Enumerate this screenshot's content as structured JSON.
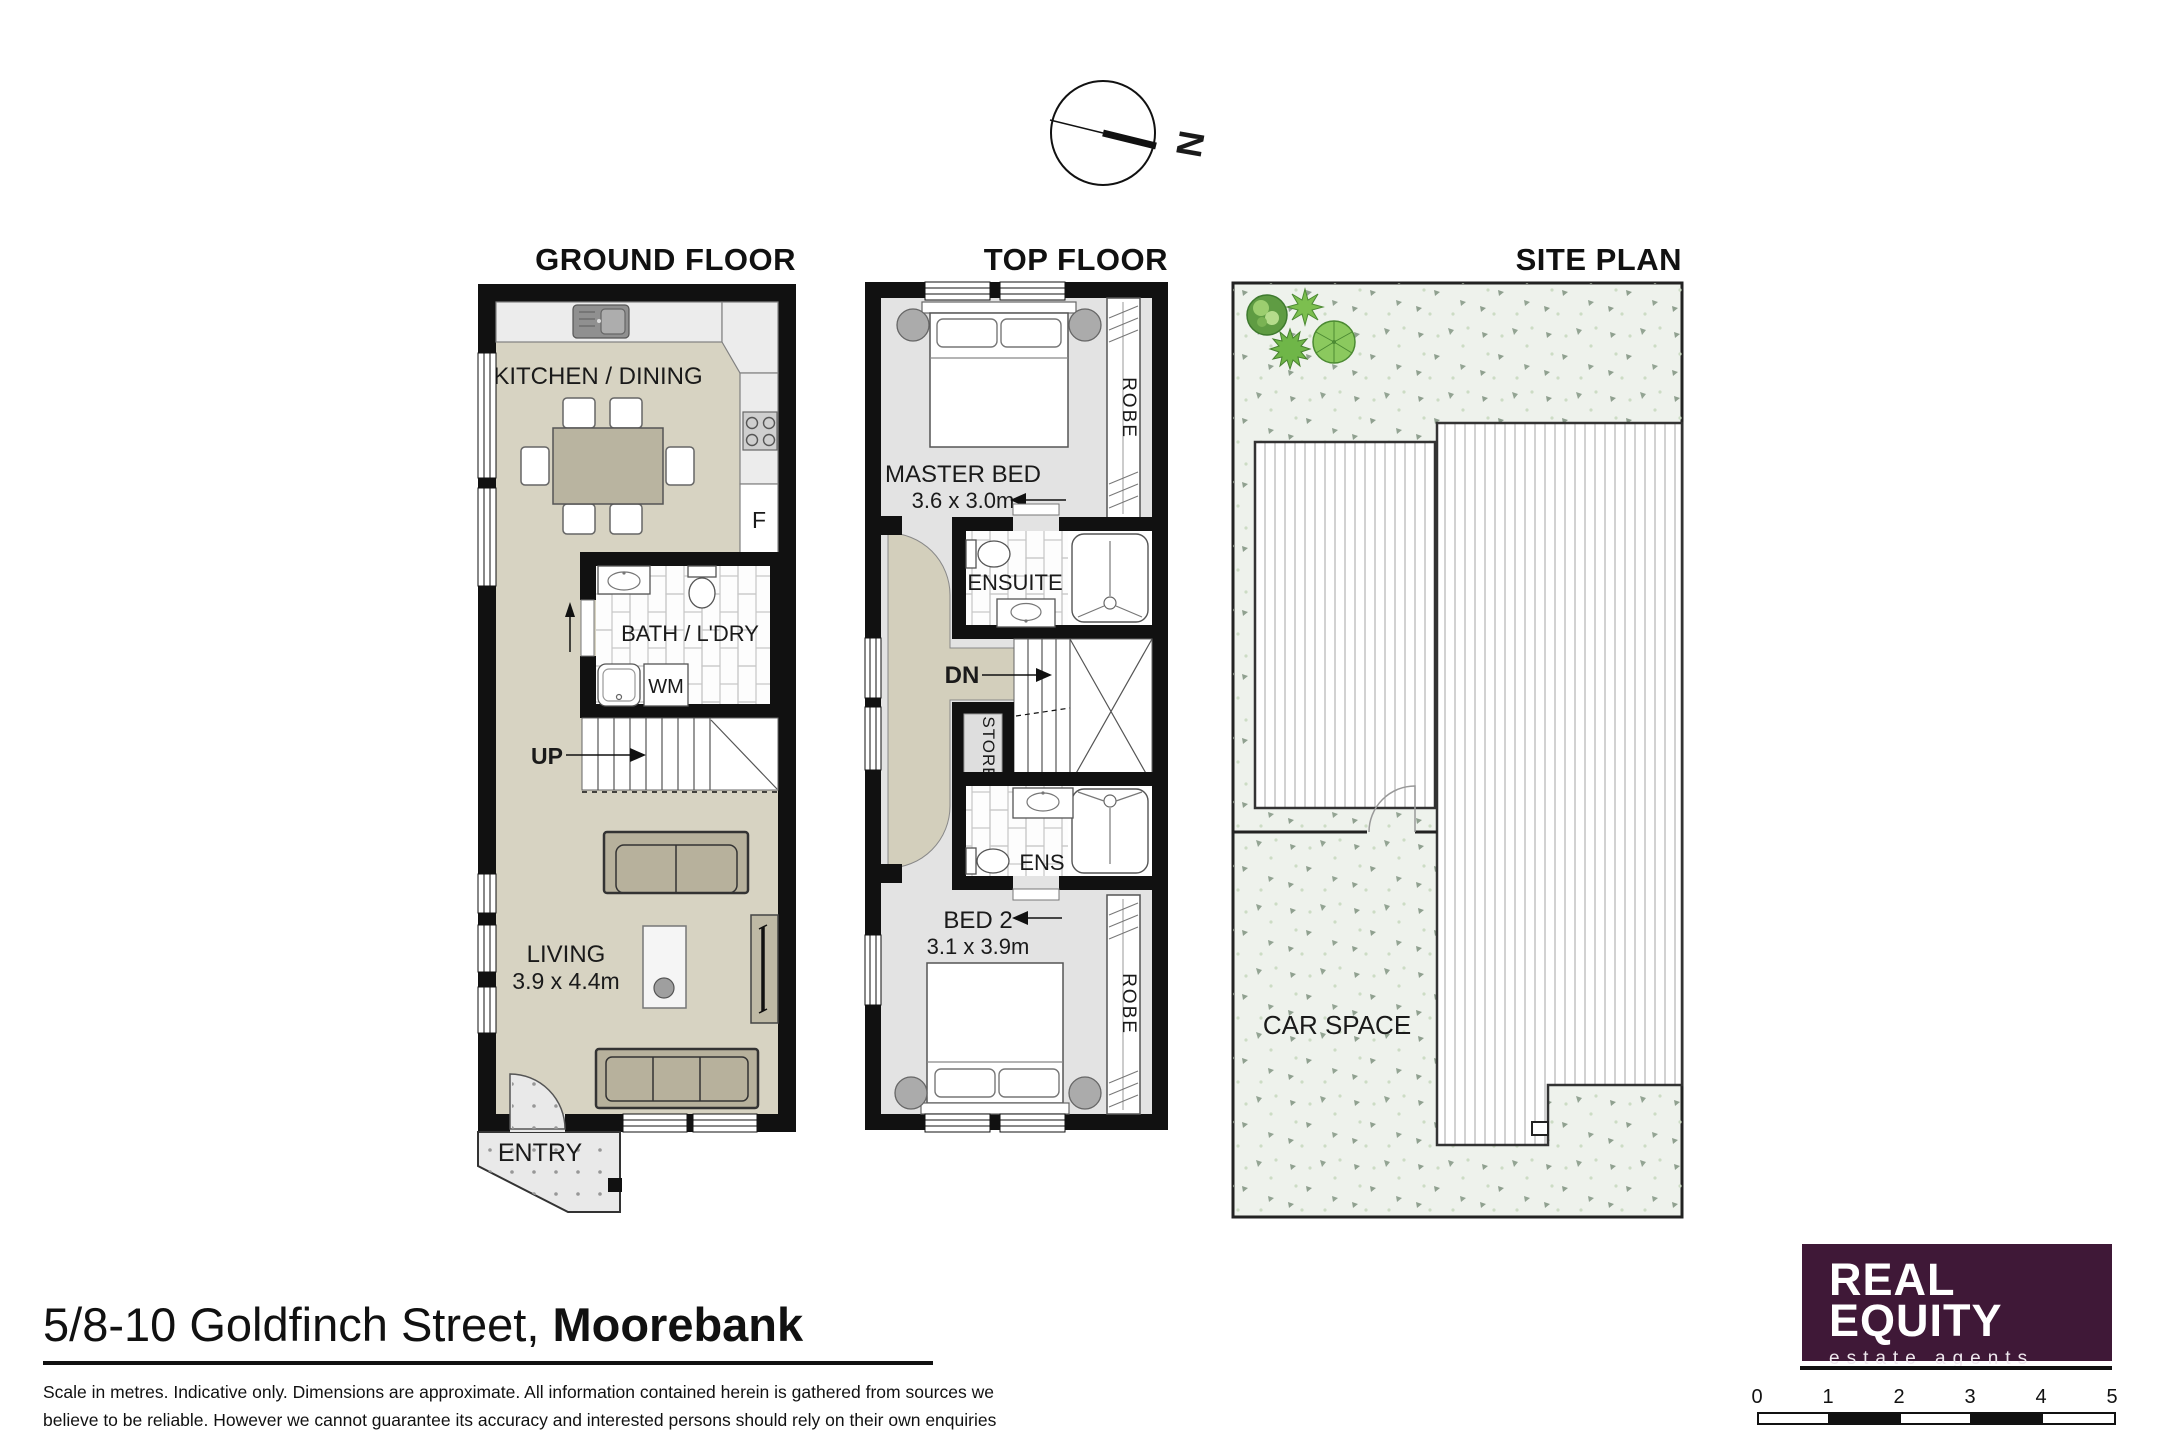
{
  "compass": {
    "north_label": "N"
  },
  "plans": {
    "ground_floor": {
      "title": "GROUND FLOOR",
      "labels": {
        "kitchen_dining": "KITCHEN / DINING",
        "fridge": "F",
        "bath_laundry": "BATH / L'DRY",
        "washing_machine": "WM",
        "stairs_up": "UP",
        "living": "LIVING",
        "living_dimensions": "3.9 x 4.4m",
        "entry": "ENTRY"
      }
    },
    "top_floor": {
      "title": "TOP FLOOR",
      "labels": {
        "master_bed": "MASTER BED",
        "master_bed_dimensions": "3.6 x 3.0m",
        "robe_master": "ROBE",
        "ensuite": "ENSUITE",
        "stairs_down": "DN",
        "store": "STORE",
        "ensuite_2": "ENS",
        "bed_2": "BED 2",
        "bed_2_dimensions": "3.1 x 3.9m",
        "robe_bed2": "ROBE"
      }
    },
    "site_plan": {
      "title": "SITE PLAN",
      "labels": {
        "car_space": "CAR SPACE"
      }
    }
  },
  "footer": {
    "address": {
      "street": "5/8-10 Goldfinch Street, ",
      "suburb": "Moorebank"
    },
    "disclaimer": {
      "line1": "Scale in metres. Indicative only. Dimensions are approximate. All information contained herein is gathered from sources we",
      "line2": "believe to be reliable. However we cannot guarantee its accuracy and interested persons should rely on their own enquiries"
    }
  },
  "logo": {
    "name_line1": "REAL",
    "name_line2": "EQUITY",
    "tagline": "estate agents",
    "background_color": "#3f1837"
  },
  "scale_bar": {
    "ticks": [
      "0",
      "1",
      "2",
      "3",
      "4",
      "5"
    ]
  },
  "colors": {
    "wall": "#111111",
    "ground_floor_fill": "#d7d3c2",
    "top_floor_fill": "#e3e3e3",
    "hallway_arc_fill": "#d3cfbc",
    "counter_fill": "#ececec",
    "furniture_fill": "#b7b19c",
    "yard_fill": "#eef2ec",
    "logo_purple": "#3f1837"
  }
}
